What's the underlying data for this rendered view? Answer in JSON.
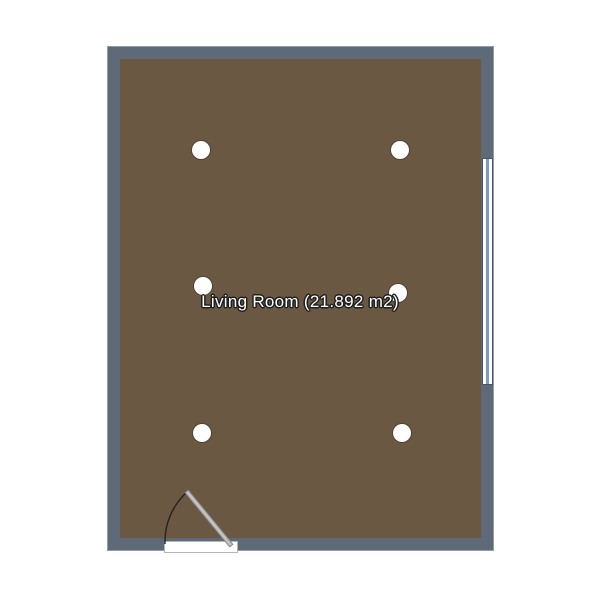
{
  "canvas": {
    "background": "#ffffff"
  },
  "room": {
    "name": "Living Room",
    "area_m2": 21.892,
    "label": "Living Room (21.892 m2)",
    "colors": {
      "wall": "#5e6a78",
      "wall_outline": "#939caa",
      "floor": "#6a5843",
      "window_frame": "#ffffff",
      "window_glass": "#7d9db5",
      "door": "#c2c2c2",
      "swing_arc": "#222222",
      "light_fill": "#ffffff",
      "label_text": "#ffffff"
    },
    "features": {
      "window_count": 1,
      "door_count": 1,
      "light_count": 6
    }
  },
  "lights": [
    {
      "x": 201,
      "y": 150
    },
    {
      "x": 400,
      "y": 150
    },
    {
      "x": 203,
      "y": 286
    },
    {
      "x": 398,
      "y": 293
    },
    {
      "x": 202,
      "y": 433
    },
    {
      "x": 402,
      "y": 433
    }
  ]
}
